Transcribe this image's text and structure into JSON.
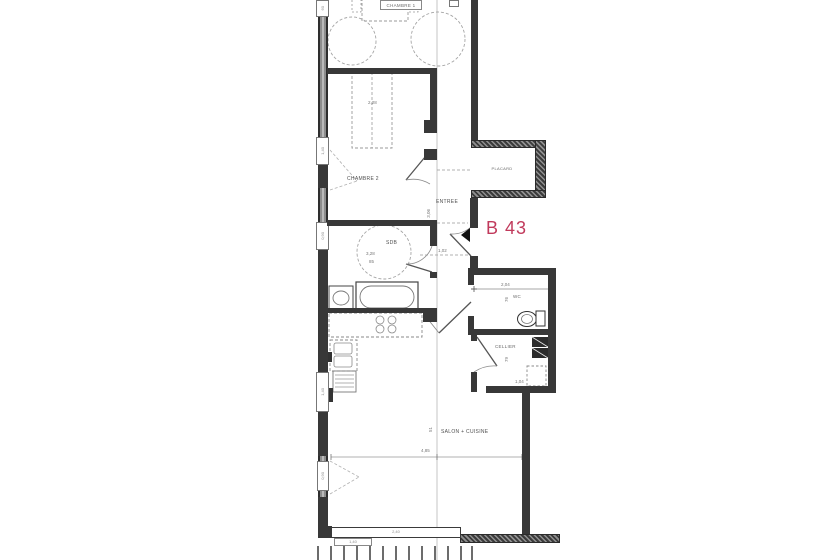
{
  "unit": {
    "label": "B 43",
    "color": "#c13a5c"
  },
  "rooms": {
    "chambre1": "CHAMBRE 1",
    "chambre2": "CHAMBRE 2",
    "sdb": "SDB",
    "entree": "ENTREE",
    "placard": "PLACARD",
    "wc": "WC",
    "cellier": "CELLIER",
    "salon": "SALON + CUISINE"
  },
  "dimensions": {
    "salon_width": "4,85",
    "salon_axis": "51",
    "entree_height": "3,06",
    "entree_width": "1,02",
    "sdb_width": "3,28",
    "sdb_offset": "85",
    "wardrobe_width": "2,28",
    "wc_width": "2,04",
    "wc_height": "76",
    "cellier_height": "79",
    "cellier_width": "1,04"
  },
  "window_tags": {
    "t1": "60",
    "t2": "1,40",
    "t3": "0,90",
    "t4": "1,40",
    "t5": "0,90",
    "bay": "2,40",
    "bay2": "1,40"
  }
}
